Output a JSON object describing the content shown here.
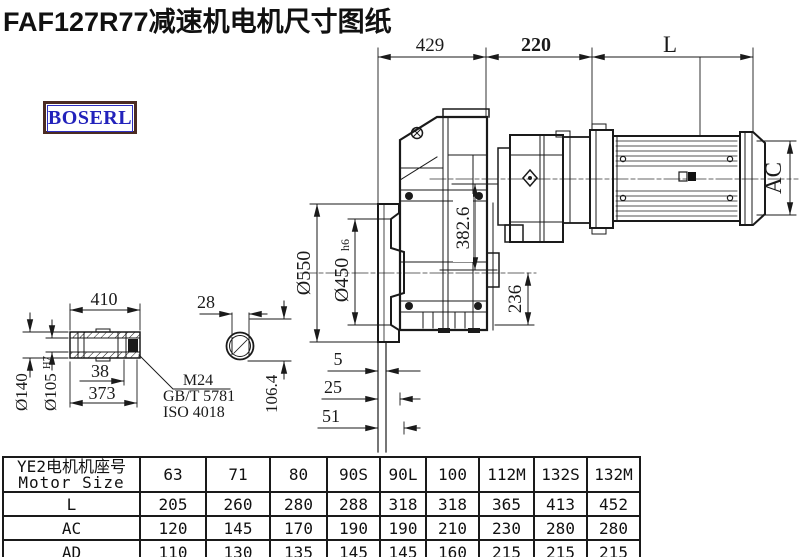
{
  "title": "FAF127R77减速机电机尺寸图纸",
  "logo": {
    "text": "BOSERL"
  },
  "colors": {
    "logo_text": "#2222bb",
    "logo_border": "#4b2b22",
    "line": "#1a1a1a"
  },
  "dims": {
    "top_429": "429",
    "top_220": "220",
    "top_L": "L",
    "ac": "AC",
    "height_382_6": "382.6",
    "base_236": "236",
    "flange_550": "Ø550",
    "spigot_450": "Ø450",
    "spigot_tol": "h6",
    "off_5": "5",
    "off_25": "25",
    "off_51": "51"
  },
  "shaft": {
    "len_410": "410",
    "od_140": "Ø140",
    "bore_105": "Ø105",
    "bore_tol": "H7",
    "dim_38": "38",
    "dim_373": "373",
    "screw": "M24",
    "std1": "GB/T 5781",
    "std2": "ISO 4018",
    "key_28": "28",
    "height_106_4": "106.4"
  },
  "table": {
    "header": {
      "line1": "YE2电机机座号",
      "line2": "Motor Size"
    },
    "columns": [
      "63",
      "71",
      "80",
      "90S",
      "90L",
      "100",
      "112M",
      "132S",
      "132M"
    ],
    "rows": [
      {
        "label": "L",
        "values": [
          "205",
          "260",
          "280",
          "288",
          "318",
          "318",
          "365",
          "413",
          "452"
        ]
      },
      {
        "label": "AC",
        "values": [
          "120",
          "145",
          "170",
          "190",
          "190",
          "210",
          "230",
          "280",
          "280"
        ]
      },
      {
        "label": "AD",
        "values": [
          "110",
          "130",
          "135",
          "145",
          "145",
          "160",
          "215",
          "215",
          "215"
        ]
      }
    ]
  }
}
